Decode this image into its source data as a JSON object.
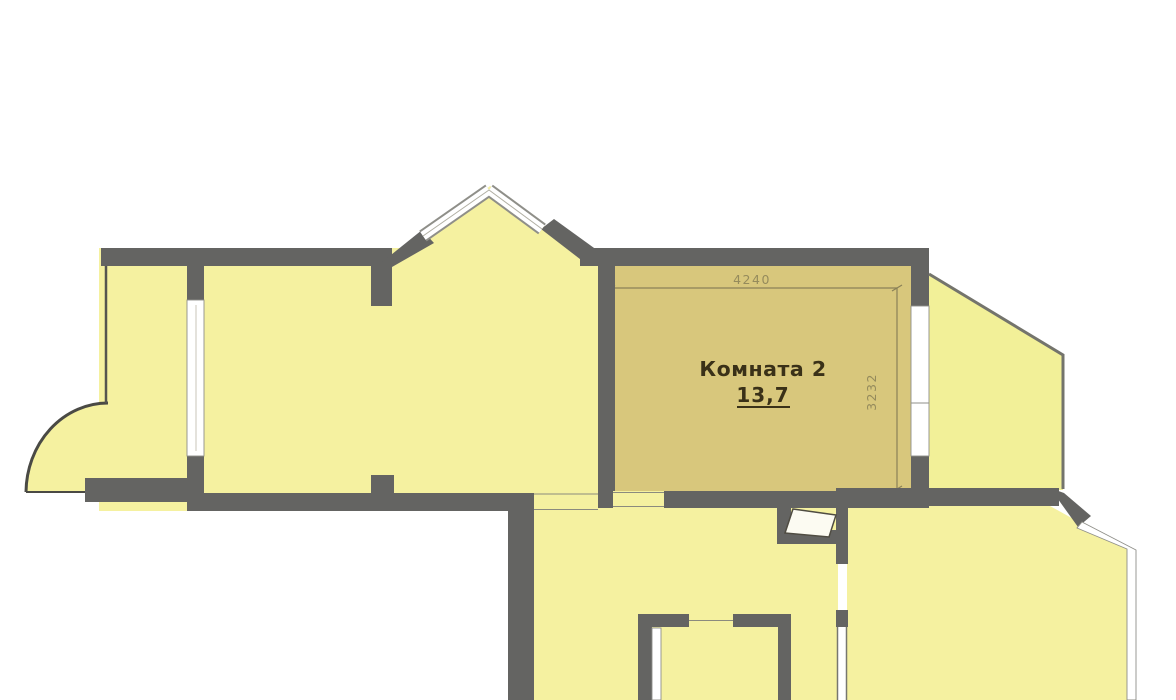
{
  "room2": {
    "label": "Комната 2",
    "area": "13,7",
    "width_dimension": "4240",
    "height_dimension": "3232"
  },
  "colors": {
    "wall": "#646462",
    "room_fill": "#f5f1a0",
    "highlight_room_fill": "#d8c77c",
    "balcony_fill": "#f2f098",
    "label_text": "#3a3118",
    "dimension": "#8a8157",
    "background": "#ffffff"
  }
}
